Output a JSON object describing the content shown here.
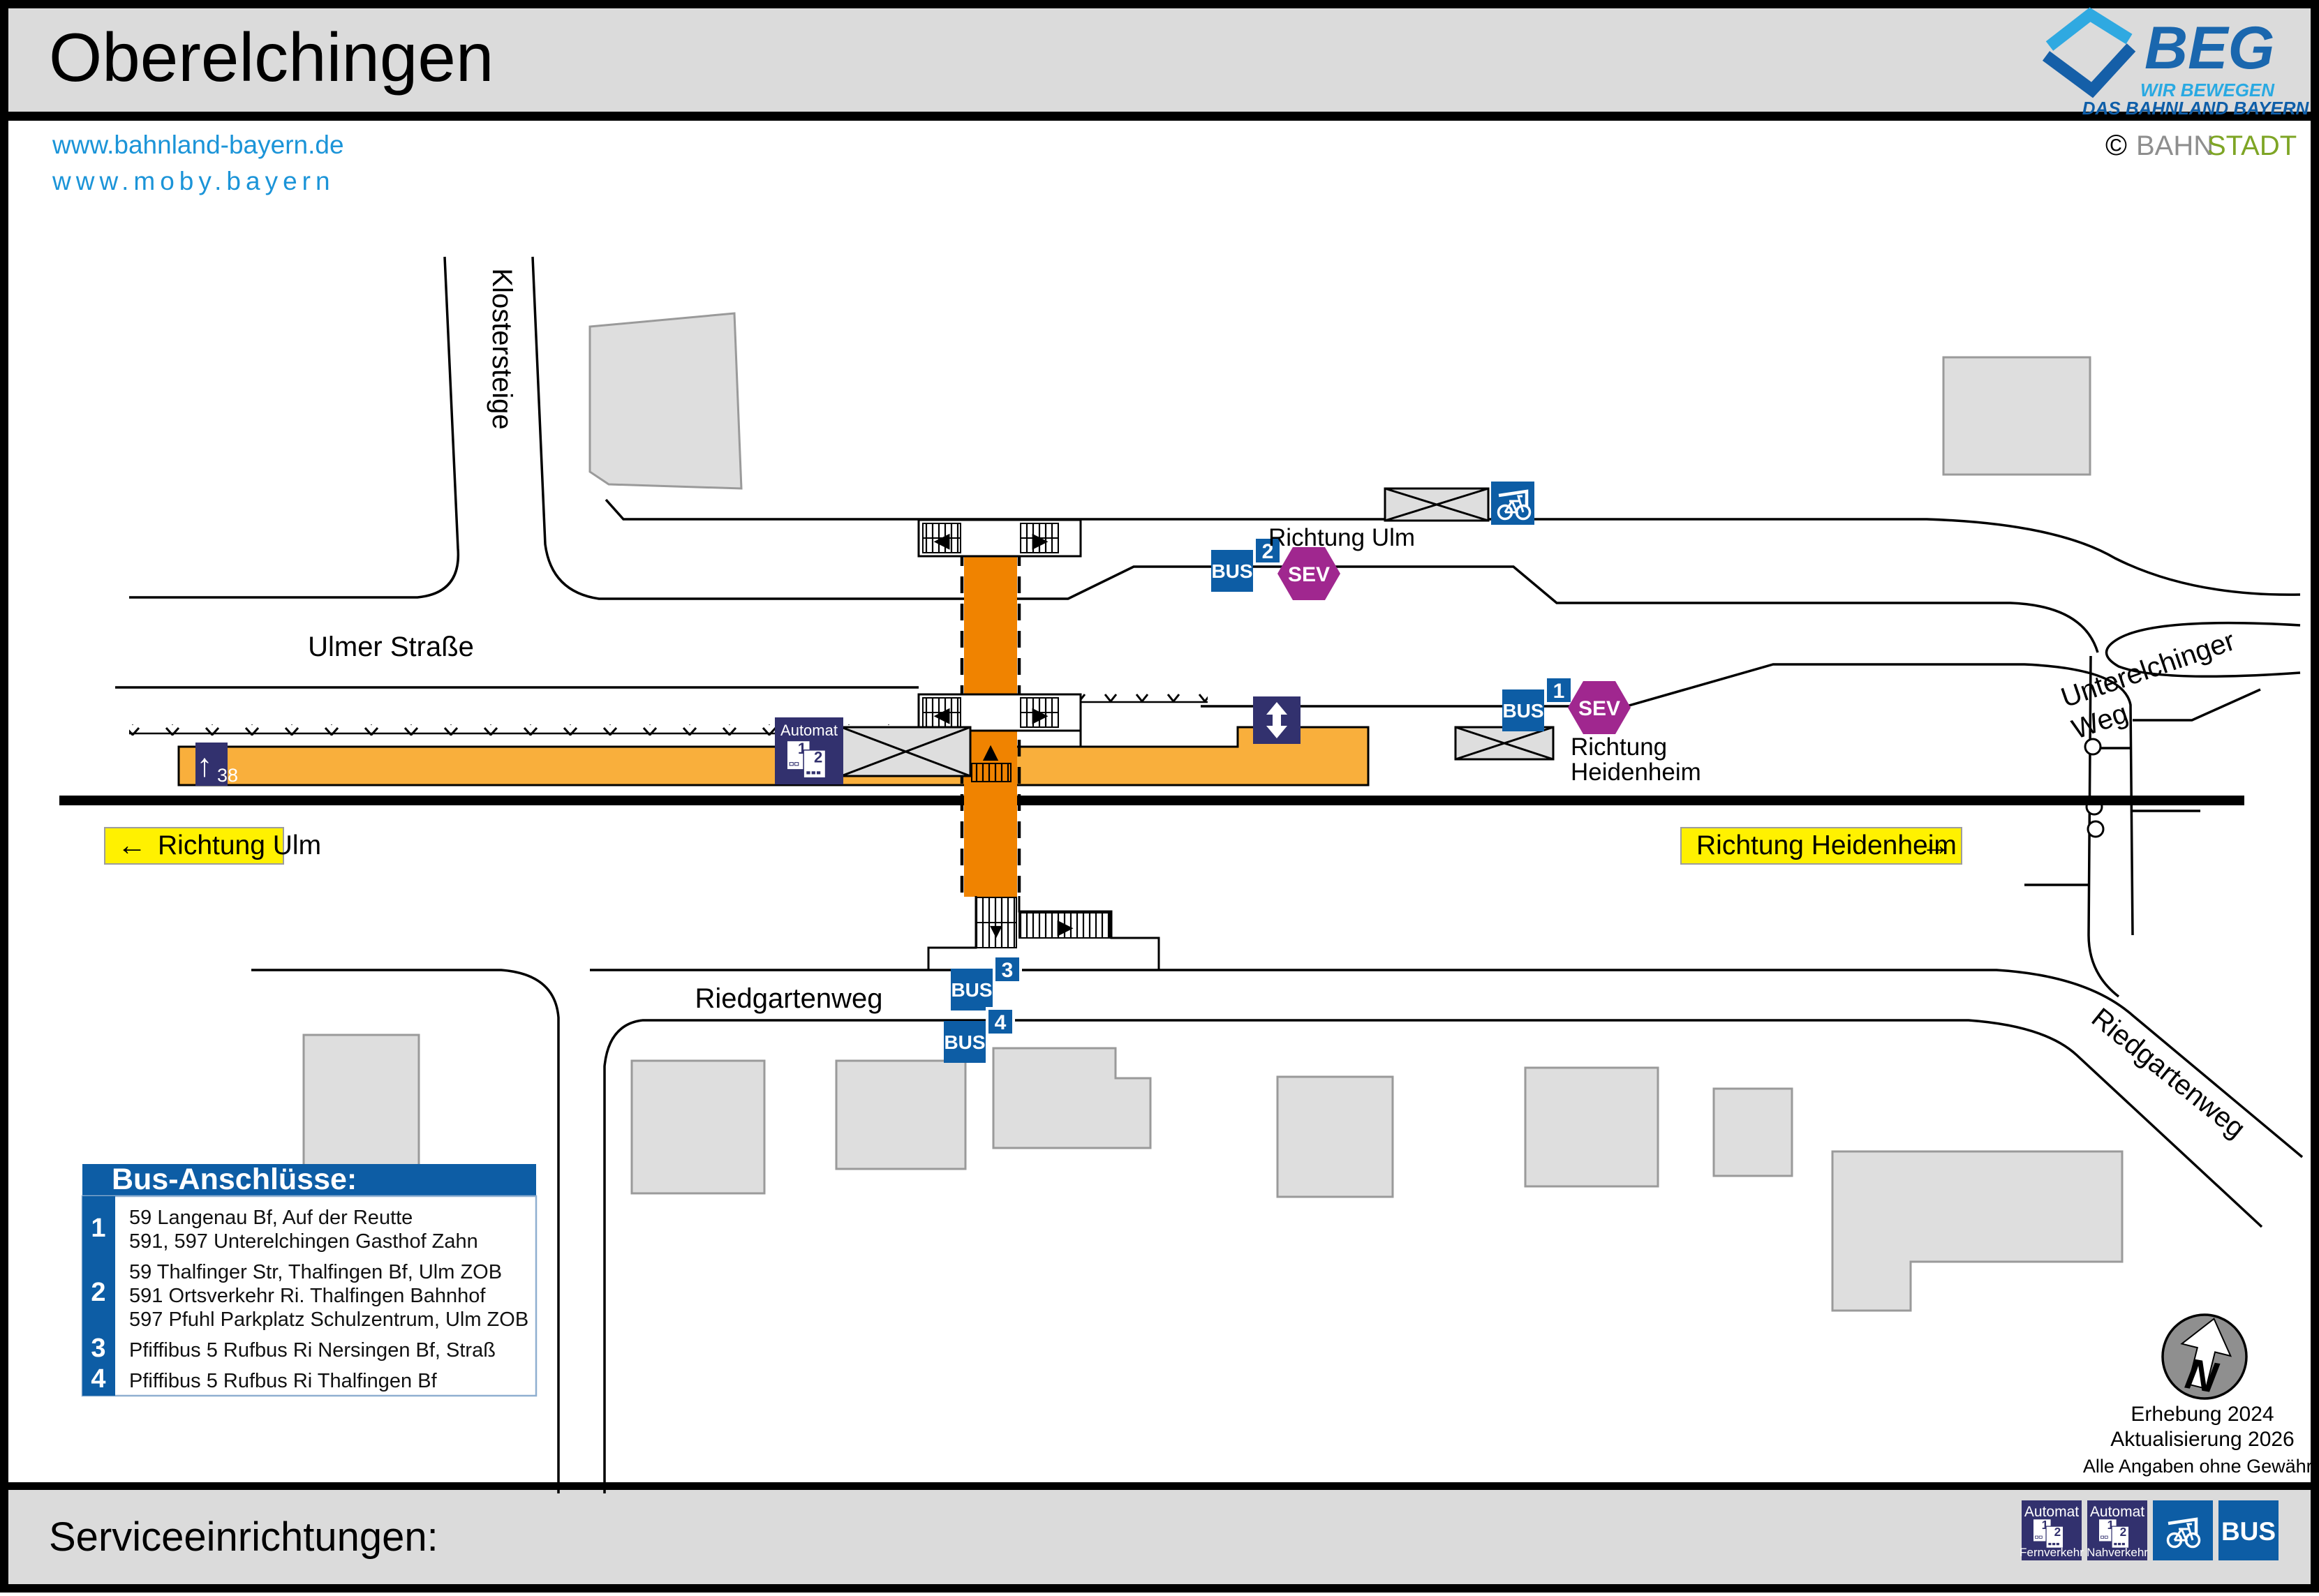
{
  "header": {
    "title": "Oberelchingen",
    "links": [
      "www.bahnland-bayern.de",
      "www.moby.bayern"
    ],
    "brand": {
      "name": "BEG",
      "tagline1": "WIR BEWEGEN",
      "tagline2": "DAS BAHNLAND BAYERN",
      "copyright": "©",
      "credit_part1": "BAHN",
      "credit_part2": "STADT"
    }
  },
  "streets": {
    "klostersteige": "Klostersteige",
    "ulmer_strasse": "Ulmer Straße",
    "riedgartenweg": "Riedgartenweg",
    "riedgartenweg_diagonal": "Riedgartenweg",
    "unterelchinger_line1": "Unterelchinger",
    "unterelchinger_line2": "Weg"
  },
  "directions": {
    "left_arrow": "←",
    "left_label": "Richtung Ulm",
    "right_label": "Richtung Heidenheim",
    "right_arrow": "→",
    "ulm_note": "Richtung Ulm",
    "heidenheim_note_line1": "Richtung",
    "heidenheim_note_line2": "Heidenheim"
  },
  "platform": {
    "arrow": "↑",
    "number": "38"
  },
  "badges": {
    "bus_label": "BUS",
    "sev_label": "SEV",
    "stop1": "1",
    "stop2": "2",
    "stop3": "3",
    "stop4": "4"
  },
  "automat": {
    "label": "Automat",
    "ticket1": "1",
    "ticket2": "2"
  },
  "stair_arrows": {
    "left": "◀",
    "right": "▶",
    "up": "▲",
    "down": "▼"
  },
  "legend": {
    "title": "Bus-Anschlüsse:",
    "items": [
      {
        "num": "1",
        "lines": [
          "59 Langenau Bf, Auf der Reutte",
          "591, 597 Unterelchingen Gasthof Zahn"
        ]
      },
      {
        "num": "2",
        "lines": [
          "59 Thalfinger Str, Thalfingen Bf, Ulm ZOB",
          "591 Ortsverkehr Ri. Thalfingen Bahnhof",
          "597 Pfuhl Parkplatz Schulzentrum, Ulm ZOB"
        ]
      },
      {
        "num": "3",
        "lines": [
          "Pfiffibus 5 Rufbus Ri Nersingen Bf, Straß"
        ]
      },
      {
        "num": "4",
        "lines": [
          "Pfiffibus 5 Rufbus Ri Thalfingen Bf"
        ]
      }
    ]
  },
  "compass": {
    "letter": "N"
  },
  "notes": [
    "Erhebung 2024",
    "Aktualisierung 2026",
    "Alle Angaben ohne Gewähr!"
  ],
  "footer": {
    "title": "Serviceeinrichtungen:",
    "automat_fern_sub": "Fernverkehr",
    "automat_nah_sub": "Nahverkehr",
    "bus_label": "BUS"
  },
  "colors": {
    "beg_blue": "#0d5da5",
    "beg_lightblue": "#2fa9e1",
    "navy": "#32316e",
    "sev_magenta": "#a0278f",
    "platform_orange": "#f9af3c",
    "crossing_orange": "#f08300",
    "direction_yellow": "#fff100",
    "link_blue": "#1b94d8",
    "band_gray": "#dbdbdb",
    "building_gray": "#dedede",
    "credit_gray": "#8e8e8e",
    "credit_green": "#7ea525"
  }
}
